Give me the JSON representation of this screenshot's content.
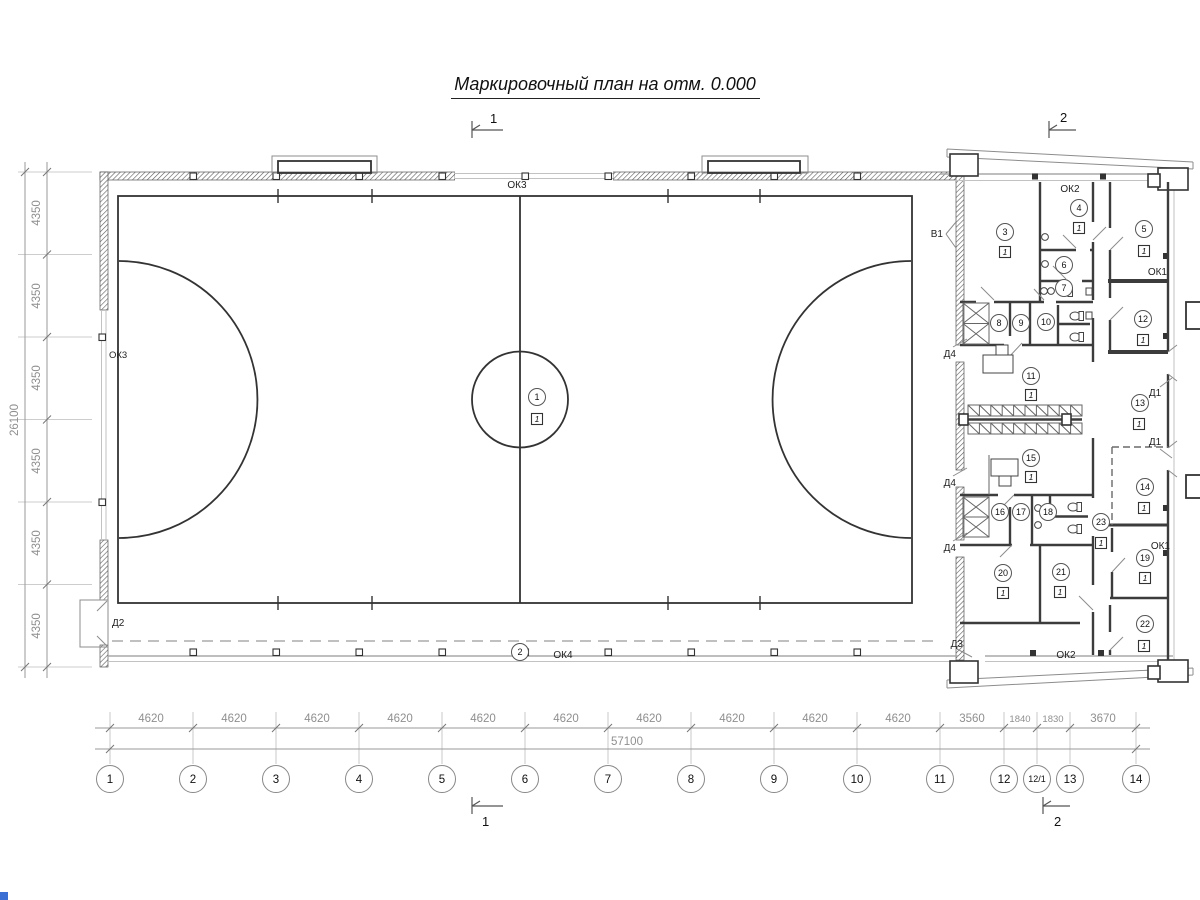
{
  "title": "Маркировочный план на отм. 0.000",
  "sections": {
    "one": "1",
    "two": "2"
  },
  "grid": {
    "cols": [
      "1",
      "2",
      "3",
      "4",
      "5",
      "6",
      "7",
      "8",
      "9",
      "10",
      "11",
      "12",
      "12/1",
      "13",
      "14"
    ]
  },
  "dims": {
    "bottom": [
      "4620",
      "4620",
      "4620",
      "4620",
      "4620",
      "4620",
      "4620",
      "4620",
      "4620",
      "4620",
      "3560",
      "1840",
      "1830",
      "3670"
    ],
    "total_width": "57100",
    "left": [
      "4350",
      "4350",
      "4350",
      "4350",
      "4350",
      "4350"
    ],
    "total_height": "26100"
  },
  "marks": {
    "field_zone": "1",
    "bottom_zone": "2",
    "floor": "1"
  },
  "rooms": {
    "r3": "3",
    "r4": "4",
    "r5": "5",
    "r6": "6",
    "r7": "7",
    "r8": "8",
    "r9": "9",
    "r10": "10",
    "r11": "11",
    "r12": "12",
    "r13": "13",
    "r14": "14",
    "r15": "15",
    "r16": "16",
    "r17": "17",
    "r18": "18",
    "r19": "19",
    "r20": "20",
    "r21": "21",
    "r22": "22",
    "r23": "23"
  },
  "labels": {
    "v1": "В1",
    "ok1": "ОК1",
    "ok2": "ОК2",
    "ok3": "ОК3",
    "ok4": "ОК4",
    "d1": "Д1",
    "d2": "Д2",
    "d3": "Д3",
    "d4": "Д4"
  }
}
